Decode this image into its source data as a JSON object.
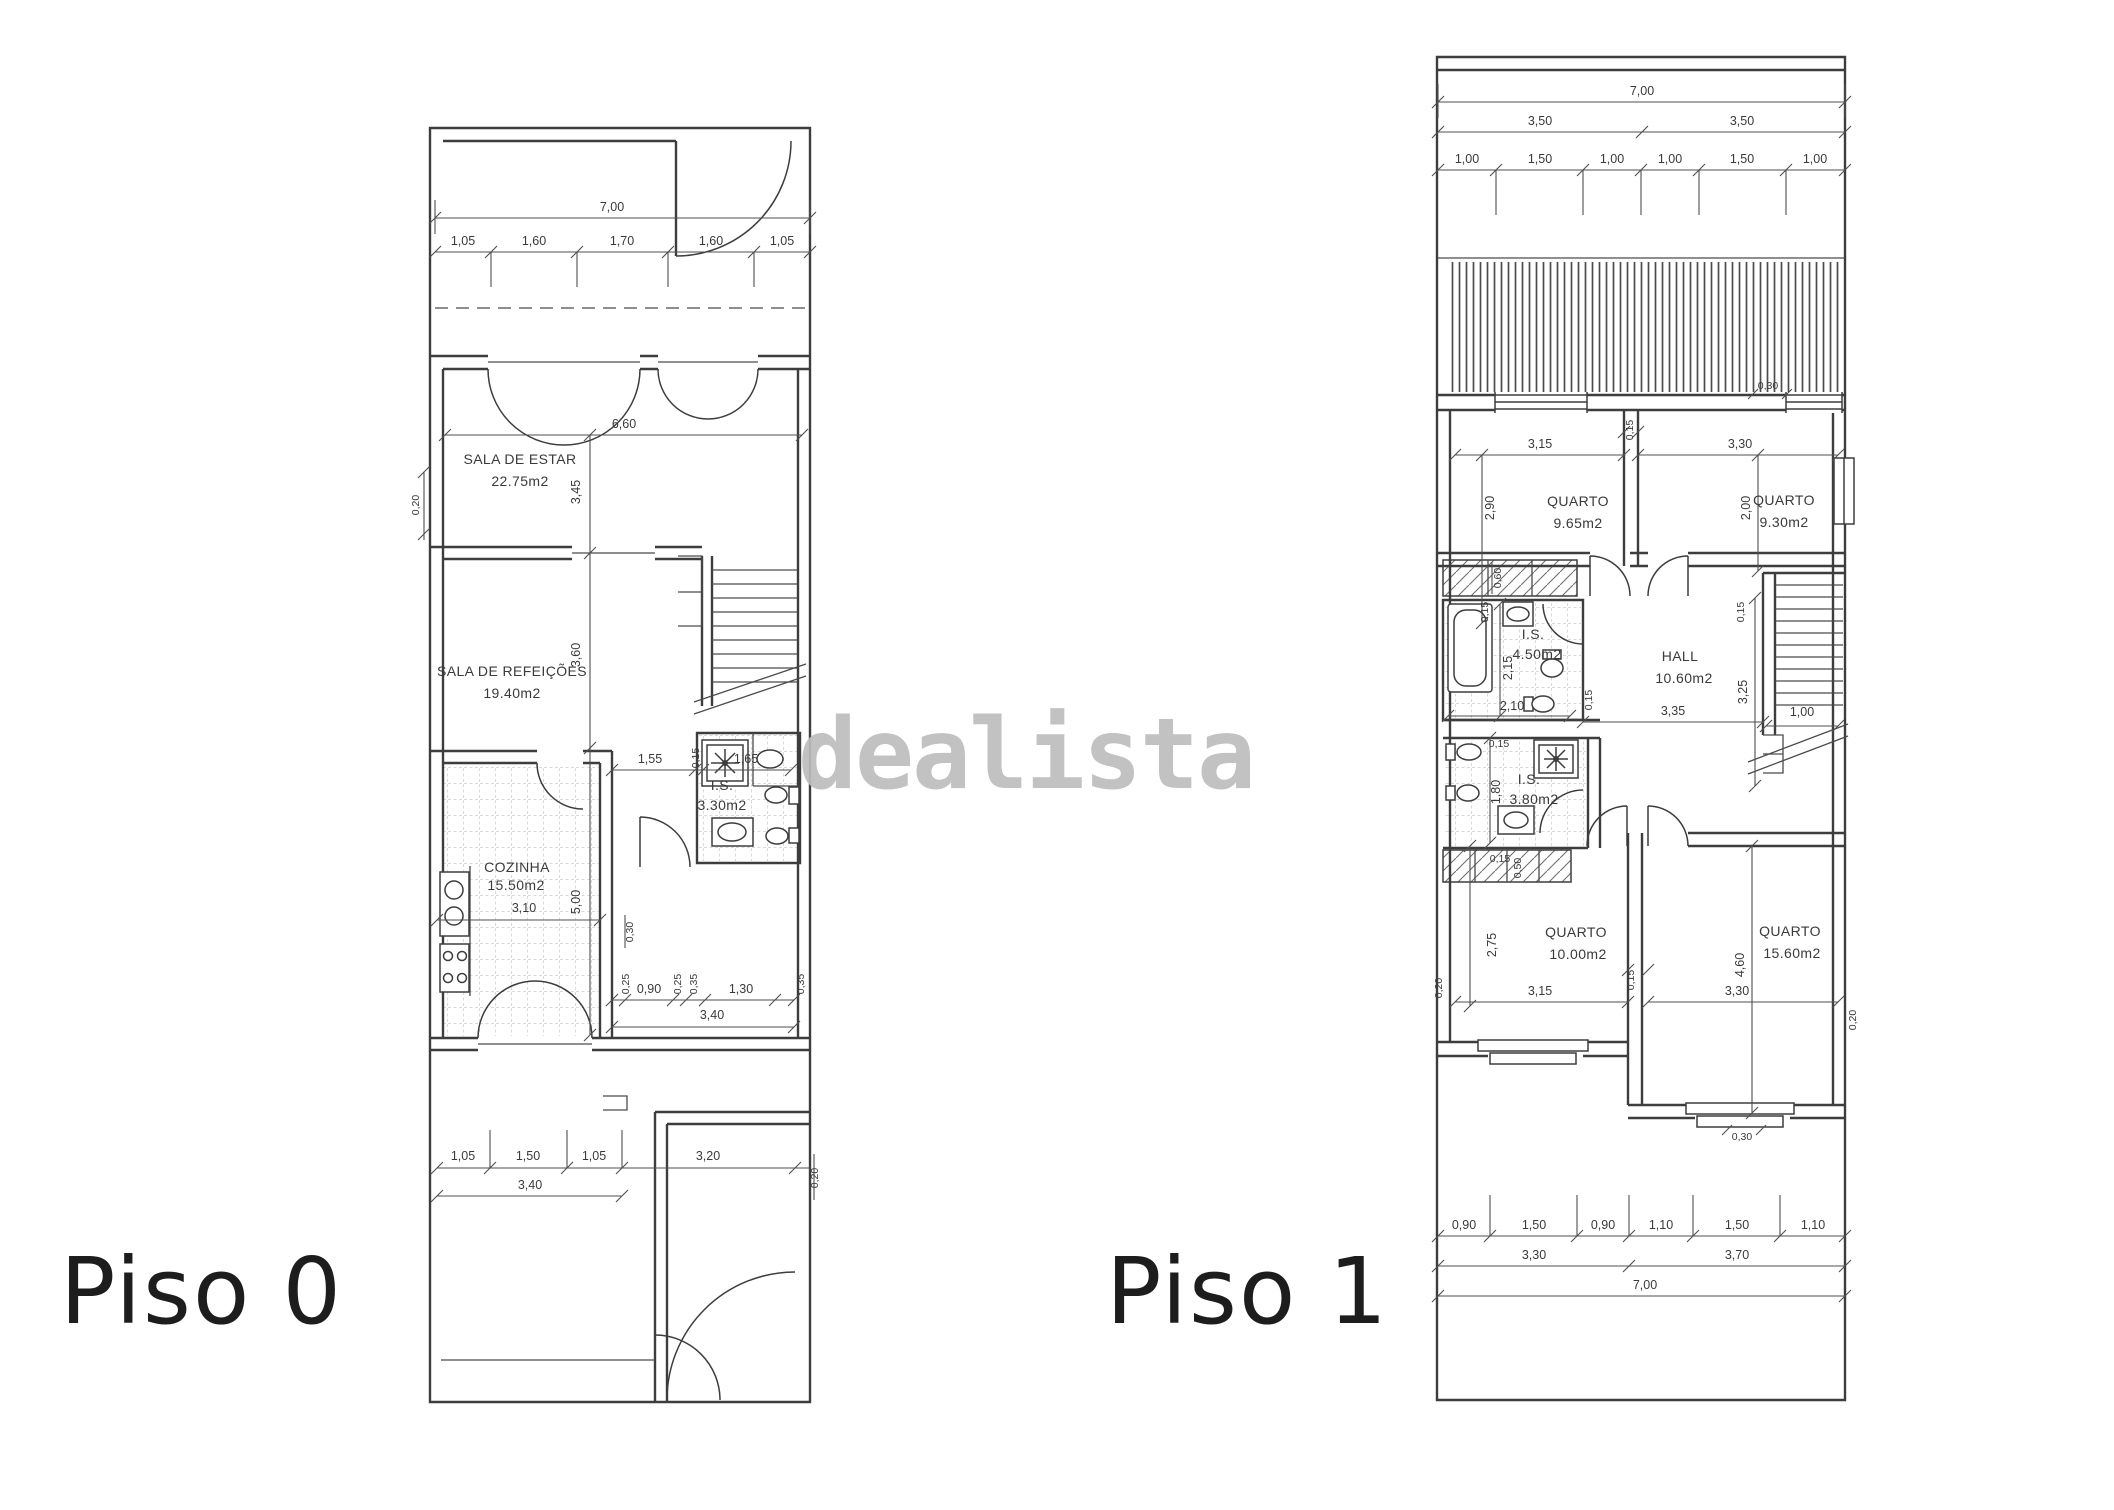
{
  "watermark": {
    "text": "dealista",
    "color": "#bdbdbd"
  },
  "piso0": {
    "label": "Piso 0",
    "rooms": [
      {
        "name": "SALA DE ESTAR",
        "area": "22.75m2"
      },
      {
        "name": "SALA DE REFEIÇÕES",
        "area": "19.40m2"
      },
      {
        "name": "COZINHA",
        "area": "15.50m2"
      },
      {
        "name": "I.S.",
        "area": "3.30m2"
      }
    ],
    "dims": [
      "7,00",
      "1,05",
      "1,60",
      "1,70",
      "1,60",
      "1,05",
      "0,20",
      "6,60",
      "3,45",
      "3,60",
      "1,55",
      "0,15",
      "1,65",
      "3,10",
      "5,00",
      "0,30",
      "0,25",
      "0,90",
      "0,25",
      "0,35",
      "1,30",
      "0,35",
      "3,40",
      "1,05",
      "1,50",
      "1,05",
      "3,20",
      "3,40",
      "0,20"
    ]
  },
  "piso1": {
    "label": "Piso 1",
    "rooms": [
      {
        "name": "QUARTO",
        "area": "9.65m2"
      },
      {
        "name": "QUARTO",
        "area": "9.30m2"
      },
      {
        "name": "I.S.",
        "area": "4.50m2"
      },
      {
        "name": "HALL",
        "area": "10.60m2"
      },
      {
        "name": "I.S.",
        "area": "3.80m2"
      },
      {
        "name": "QUARTO",
        "area": "10.00m2"
      },
      {
        "name": "QUARTO",
        "area": "15.60m2"
      }
    ],
    "dims": [
      "7,00",
      "3,50",
      "3,50",
      "1,00",
      "1,50",
      "1,00",
      "1,00",
      "1,50",
      "1,00",
      "0,30",
      "3,15",
      "0,15",
      "3,30",
      "2,90",
      "2,00",
      "0,60",
      "0,15",
      "2,15",
      "2,10",
      "0,15",
      "3,35",
      "3,25",
      "1,00",
      "0,15",
      "0,15",
      "1,80",
      "0,15",
      "0,50",
      "2,75",
      "3,15",
      "0,15",
      "0,20",
      "4,60",
      "3,30",
      "0,20",
      "0,30",
      "0,90",
      "1,50",
      "0,90",
      "1,10",
      "1,50",
      "1,10",
      "3,30",
      "3,70",
      "7,00"
    ]
  }
}
